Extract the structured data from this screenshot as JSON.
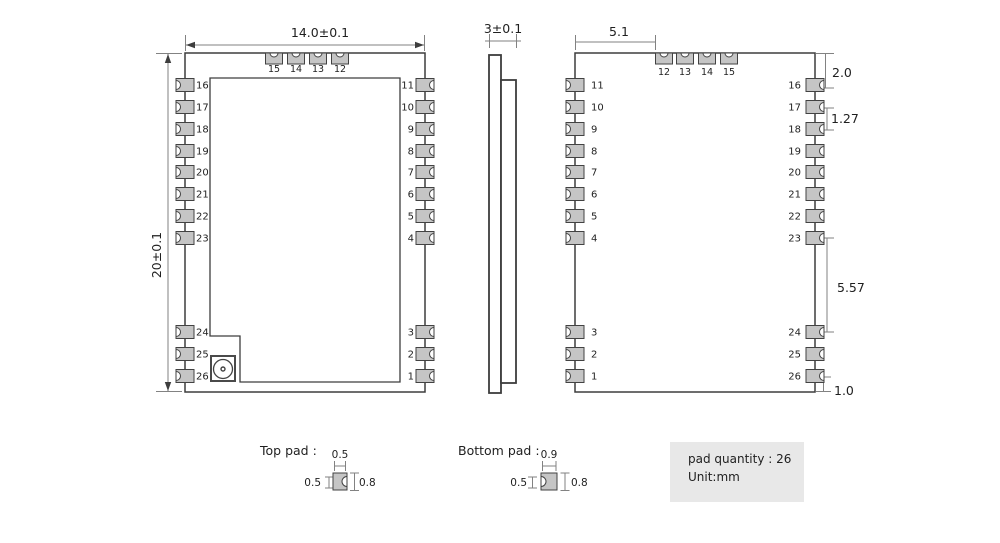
{
  "drawing": {
    "front_view": {
      "width_dim": "14.0±0.1",
      "height_dim": "20±0.1",
      "top_pad_numbers": [
        "15",
        "14",
        "13",
        "12"
      ],
      "left_pad_numbers_upper": [
        "16",
        "17",
        "18",
        "19",
        "20",
        "21",
        "22",
        "23"
      ],
      "left_pad_numbers_lower": [
        "24",
        "25",
        "26"
      ],
      "right_pad_numbers_upper": [
        "11",
        "10",
        "9",
        "8",
        "7",
        "6",
        "5",
        "4"
      ],
      "right_pad_numbers_lower": [
        "3",
        "2",
        "1"
      ]
    },
    "side_view": {
      "thickness_dim": "3±0.1"
    },
    "back_view": {
      "offset_dim": "5.1",
      "top_pad_numbers": [
        "12",
        "13",
        "14",
        "15"
      ],
      "left_pad_numbers_upper": [
        "11",
        "10",
        "9",
        "8",
        "7",
        "6",
        "5",
        "4"
      ],
      "left_pad_numbers_lower": [
        "3",
        "2",
        "1"
      ],
      "right_pad_numbers_upper": [
        "16",
        "17",
        "18",
        "19",
        "20",
        "21",
        "22",
        "23"
      ],
      "right_pad_numbers_lower": [
        "24",
        "25",
        "26"
      ],
      "edge_dim_top": "2.0",
      "pitch_dim": "1.27",
      "gap_dim": "5.57",
      "edge_dim_bottom": "1.0"
    },
    "top_pad_detail": {
      "label": "Top pad :",
      "width_dim": "0.5",
      "height_dim": "0.5",
      "length_dim": "0.8"
    },
    "bottom_pad_detail": {
      "label": "Bottom pad :",
      "width_dim": "0.9",
      "height_dim": "0.5",
      "length_dim": "0.8"
    },
    "info_box": {
      "pad_quantity": "pad quantity : 26",
      "unit": "Unit:mm"
    }
  },
  "colors": {
    "outline": "#3d3d3d",
    "dim_line": "#828282",
    "pad_fill": "#c5c5c5",
    "pad_stroke": "#424242",
    "text": "#1f1f1f",
    "info_box_bg": "#e8e8e8",
    "background": "#ffffff"
  }
}
